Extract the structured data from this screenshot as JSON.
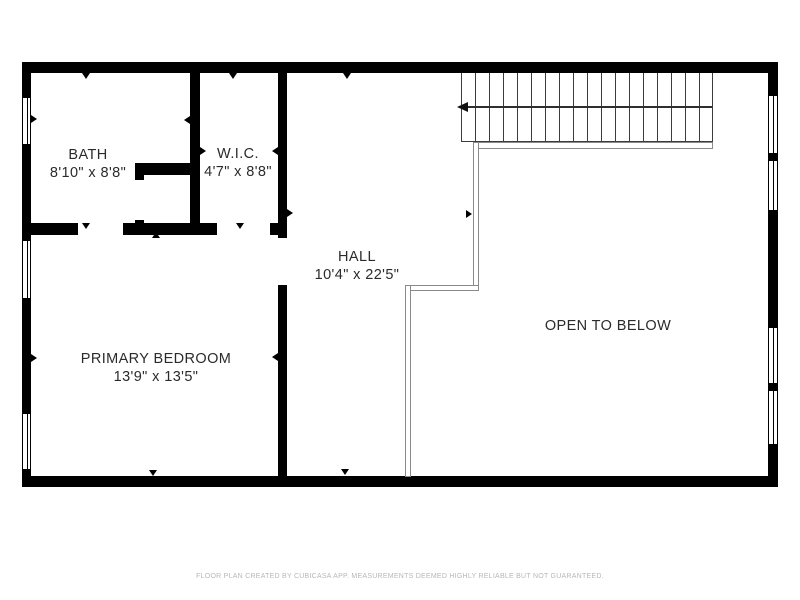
{
  "rooms": {
    "bath": {
      "name": "BATH",
      "dims": "8'10\" x 8'8\""
    },
    "wic": {
      "name": "W.I.C.",
      "dims": "4'7\" x 8'8\""
    },
    "hall": {
      "name": "HALL",
      "dims": "10'4\" x 22'5\""
    },
    "primary_bedroom": {
      "name": "PRIMARY BEDROOM",
      "dims": "13'9\" x 13'5\""
    },
    "open_to_below": {
      "name": "OPEN TO BELOW"
    }
  },
  "annotations": {
    "stair_direction_icon": "left-arrow",
    "wall_marker_icon": "small-triangle"
  },
  "footer": {
    "disclaimer": "FLOOR PLAN CREATED BY CUBICASA APP. MEASUREMENTS DEEMED HIGHLY RELIABLE BUT NOT GUARANTEED."
  },
  "colors": {
    "background": "#ffffff",
    "wall": "#000000",
    "room_text": "#2b2b2b",
    "footer_text": "#b4b8bb",
    "stair_lines": "#3c3c3c",
    "railing_lines": "#8a8a8a"
  }
}
